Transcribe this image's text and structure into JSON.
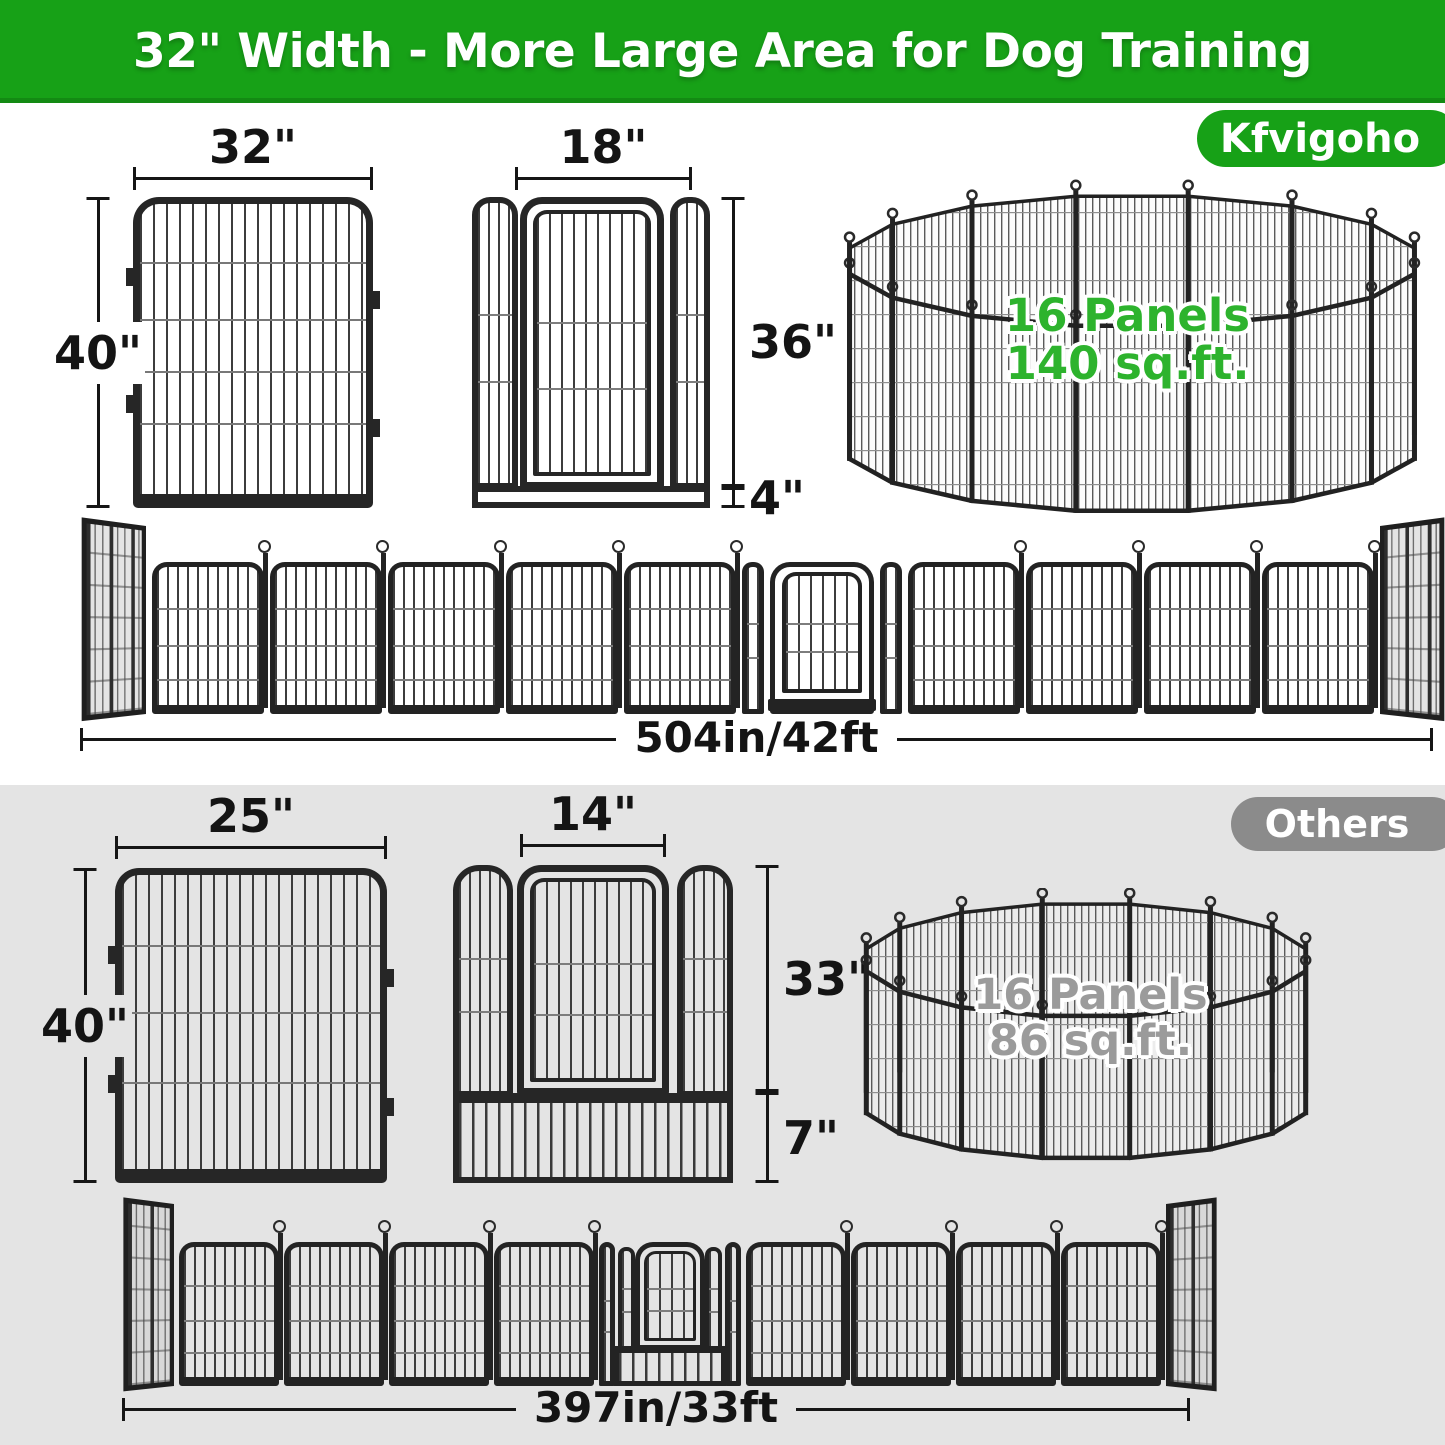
{
  "banner": {
    "title": "32\" Width - More Large Area for Dog Training"
  },
  "kfvigoho": {
    "badge": "Kfvigoho",
    "panel": {
      "width_label": "32\"",
      "height_label": "40\""
    },
    "door": {
      "width_label": "18\"",
      "height_label": "36\"",
      "bottom_label": "4\""
    },
    "pen": {
      "panels_label": "16 Panels",
      "area_label": "140 sq.ft."
    },
    "row": {
      "length_label": "504in/42ft"
    }
  },
  "others": {
    "badge": "Others",
    "panel": {
      "width_label": "25\"",
      "height_label": "40\""
    },
    "door": {
      "width_label": "14\"",
      "height_label": "33\"",
      "bottom_label": "7\""
    },
    "pen": {
      "panels_label": "16 Panels",
      "area_label": "86 sq.ft."
    },
    "row": {
      "length_label": "397in/33ft"
    }
  },
  "colors": {
    "banner_green": "#17a117",
    "accent_green": "#2db32d",
    "badge_gray": "#8b8b8b",
    "section_gray": "#e4e4e4",
    "fence_dark": "#232323"
  }
}
